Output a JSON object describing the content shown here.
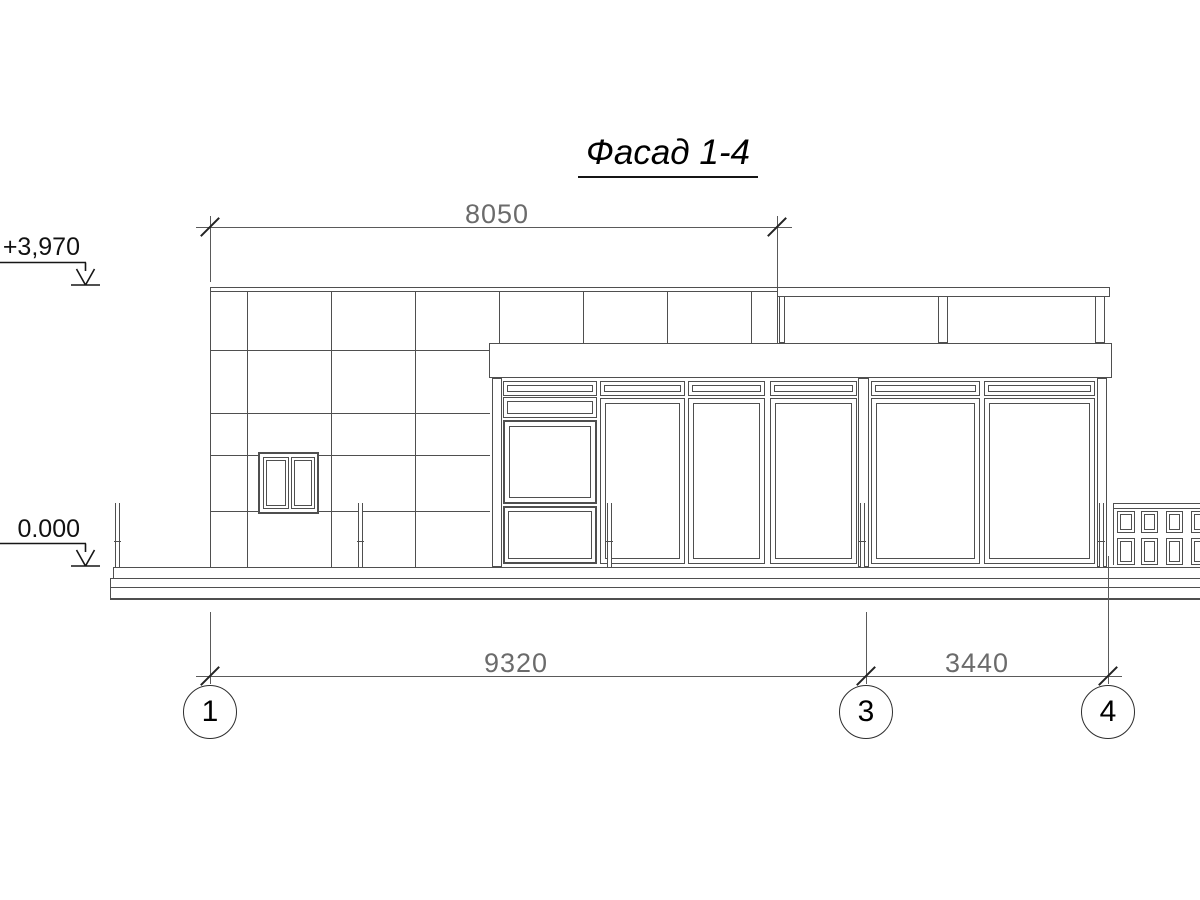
{
  "drawing": {
    "title": "Фасад 1-4",
    "elevation_marks": {
      "parapet": "+3,970",
      "ground": "0.000"
    },
    "dimensions": {
      "top_span": "8050",
      "bottom_span_1_3": "9320",
      "bottom_span_3_4": "3440"
    },
    "axes": [
      "1",
      "3",
      "4"
    ],
    "colors": {
      "line": "#4f4f4f",
      "dimension_line": "#5a5a5a",
      "dimension_text": "#6b6b6b",
      "text": "#111111",
      "background": "#ffffff"
    }
  }
}
